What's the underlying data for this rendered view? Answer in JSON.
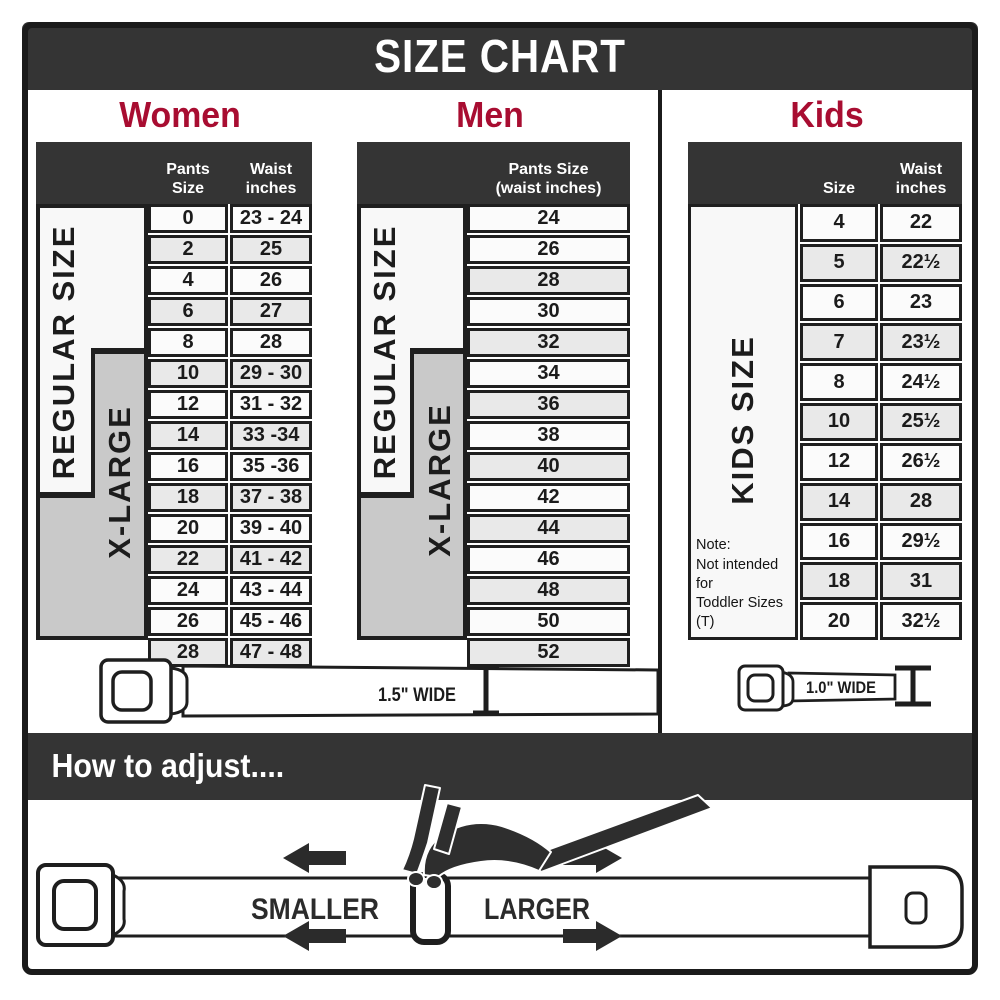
{
  "banner": {
    "title": "SIZE CHART"
  },
  "colors": {
    "banner_bg": "#343434",
    "heading_red": "#a80d31",
    "border_dark": "#1b1b1b",
    "row_plain": "#fbfbfb",
    "row_shaded": "#e9e9e9",
    "xlarge_gray": "#c9c9c9",
    "regular_white": "#f8f8f8"
  },
  "sections": {
    "women": {
      "heading": "Women",
      "col1_header": "Pants Size",
      "col2_header": "Waist\ninches",
      "regular_label": "REGULAR SIZE",
      "xlarge_label": "X-LARGE",
      "belt": {
        "width_label": "1.5\" WIDE"
      }
    },
    "men": {
      "heading": "Men",
      "col_header": "Pants Size\n(waist inches)",
      "regular_label": "REGULAR SIZE",
      "xlarge_label": "X-LARGE"
    },
    "kids": {
      "heading": "Kids",
      "col1_header": "Size",
      "col2_header": "Waist\ninches",
      "side_label": "KIDS SIZE",
      "note": "Note:\nNot intended for\nToddler Sizes (T)",
      "belt": {
        "width_label": "1.0\" WIDE"
      }
    }
  },
  "adjust": {
    "heading": "How to adjust....",
    "smaller_label": "SMALLER",
    "larger_label": "LARGER"
  },
  "chart_data": [
    {
      "type": "table",
      "title": "Women",
      "columns": [
        "Pants Size",
        "Waist inches"
      ],
      "rows": [
        {
          "size": "0",
          "waist": "23 - 24",
          "shaded": false
        },
        {
          "size": "2",
          "waist": "25",
          "shaded": true
        },
        {
          "size": "4",
          "waist": "26",
          "shaded": false
        },
        {
          "size": "6",
          "waist": "27",
          "shaded": true
        },
        {
          "size": "8",
          "waist": "28",
          "shaded": false
        },
        {
          "size": "10",
          "waist": "29 - 30",
          "shaded": true
        },
        {
          "size": "12",
          "waist": "31 - 32",
          "shaded": false
        },
        {
          "size": "14",
          "waist": "33 -34",
          "shaded": true
        },
        {
          "size": "16",
          "waist": "35 -36",
          "shaded": false
        },
        {
          "size": "18",
          "waist": "37 - 38",
          "shaded": true
        },
        {
          "size": "20",
          "waist": "39 - 40",
          "shaded": false
        },
        {
          "size": "22",
          "waist": "41 - 42",
          "shaded": true
        },
        {
          "size": "24",
          "waist": "43 - 44",
          "shaded": false
        },
        {
          "size": "26",
          "waist": "45 - 46",
          "shaded": false
        },
        {
          "size": "28",
          "waist": "47 - 48",
          "shaded": true
        }
      ]
    },
    {
      "type": "table",
      "title": "Men",
      "columns": [
        "Pants Size (waist inches)"
      ],
      "rows": [
        {
          "size": "24",
          "shaded": false
        },
        {
          "size": "26",
          "shaded": false
        },
        {
          "size": "28",
          "shaded": true
        },
        {
          "size": "30",
          "shaded": false
        },
        {
          "size": "32",
          "shaded": true
        },
        {
          "size": "34",
          "shaded": false
        },
        {
          "size": "36",
          "shaded": true
        },
        {
          "size": "38",
          "shaded": false
        },
        {
          "size": "40",
          "shaded": true
        },
        {
          "size": "42",
          "shaded": false
        },
        {
          "size": "44",
          "shaded": true
        },
        {
          "size": "46",
          "shaded": false
        },
        {
          "size": "48",
          "shaded": true
        },
        {
          "size": "50",
          "shaded": false
        },
        {
          "size": "52",
          "shaded": true
        }
      ]
    },
    {
      "type": "table",
      "title": "Kids",
      "columns": [
        "Size",
        "Waist inches"
      ],
      "rows": [
        {
          "size": "4",
          "waist": "22",
          "shaded": false
        },
        {
          "size": "5",
          "waist": "22½",
          "shaded": true
        },
        {
          "size": "6",
          "waist": "23",
          "shaded": false
        },
        {
          "size": "7",
          "waist": "23½",
          "shaded": true
        },
        {
          "size": "8",
          "waist": "24½",
          "shaded": false
        },
        {
          "size": "10",
          "waist": "25½",
          "shaded": true
        },
        {
          "size": "12",
          "waist": "26½",
          "shaded": false
        },
        {
          "size": "14",
          "waist": "28",
          "shaded": true
        },
        {
          "size": "16",
          "waist": "29½",
          "shaded": false
        },
        {
          "size": "18",
          "waist": "31",
          "shaded": true
        },
        {
          "size": "20",
          "waist": "32½",
          "shaded": false
        }
      ]
    }
  ]
}
